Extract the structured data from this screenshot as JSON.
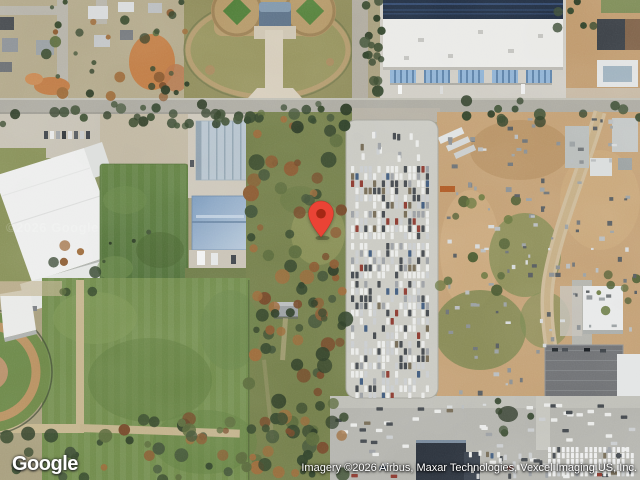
{
  "branding": {
    "logo_text": "Google"
  },
  "attribution": {
    "text": "Imagery ©2026 Airbus, Maxar Technologies, Vexcel Imaging US, Inc."
  },
  "watermark": {
    "text": "©2026 Google"
  },
  "marker": {
    "fill": "#EA4335",
    "dot": "#A52714"
  }
}
